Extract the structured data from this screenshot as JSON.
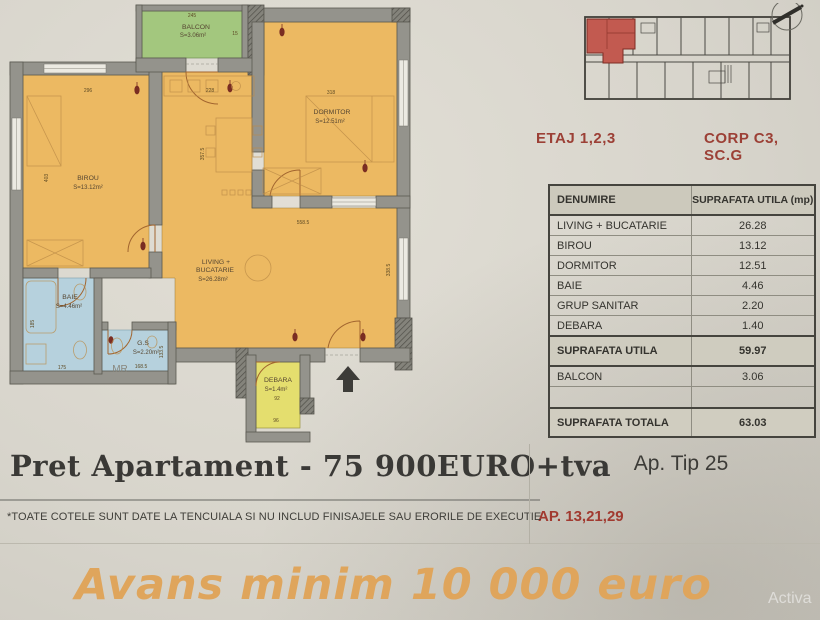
{
  "keyplan": {
    "etaj": "ETAJ 1,2,3",
    "corp": "CORP C3, SC.G"
  },
  "table": {
    "headers": [
      "DENUMIRE",
      "SUPRAFATA UTILA (mp)"
    ],
    "rows": [
      {
        "name": "LIVING + BUCATARIE",
        "value": "26.28"
      },
      {
        "name": "BIROU",
        "value": "13.12"
      },
      {
        "name": "DORMITOR",
        "value": "12.51"
      },
      {
        "name": "BAIE",
        "value": "4.46"
      },
      {
        "name": "GRUP SANITAR",
        "value": "2.20"
      },
      {
        "name": "DEBARA",
        "value": "1.40"
      },
      {
        "name": "SUPRAFATA UTILA",
        "value": "59.97"
      },
      {
        "name": "BALCON",
        "value": "3.06"
      },
      {
        "name": "",
        "value": ""
      },
      {
        "name": "SUPRAFATA TOTALA",
        "value": "63.03"
      }
    ]
  },
  "labels": {
    "ap_tip": "Ap. Tip 25",
    "ap_nums": "AP. 13,21,29"
  },
  "price": "Pret Apartament - 75 900EURO+tva",
  "disclaimer": "*TOATE COTELE SUNT DATE LA TENCUIALA SI NU INCLUD FINISAJELE SAU ERORILE DE EXECUTIE",
  "banner": "Avans minim  10 000 euro",
  "watermark": "Activa",
  "plan": {
    "rooms": {
      "balcon_name": "BALCON",
      "balcon_area": "S=3.06m²",
      "dormitor_name": "DORMITOR",
      "dormitor_area": "S=12.51m²",
      "birou_name": "BIROU",
      "birou_area": "S=13.12m²",
      "living_l1": "LIVING +",
      "living_l2": "BUCATARIE",
      "living_area": "S=26.28m²",
      "baie_name": "BAIE",
      "baie_area": "S=4.46m²",
      "gs_name": "G.S",
      "gs_area": "S=2.20m²",
      "debara_name": "DEBARA",
      "debara_area": "S=1.4m²",
      "mr": "MR"
    },
    "dims": {
      "d245": "245",
      "d15": "15",
      "d296": "296",
      "d403": "403",
      "d228": "228",
      "d318": "318",
      "d3575": "357.5",
      "d5585": "558.5",
      "d3385": "338.5",
      "d175": "175",
      "d185": "185",
      "d1685": "168.5",
      "d1335": "133.5",
      "d92": "92",
      "d96": "96"
    }
  },
  "colors": {
    "room_orange": "#ecb962",
    "room_green": "#a3c77e",
    "room_blue": "#b6d1dd",
    "room_yellow": "#e4de6e",
    "wall_gray": "#94938c",
    "accent_red": "#9c4036",
    "keyplan_red": "#c25a50",
    "banner_orange": "#dfa55c",
    "price_dark": "#3a3936"
  }
}
